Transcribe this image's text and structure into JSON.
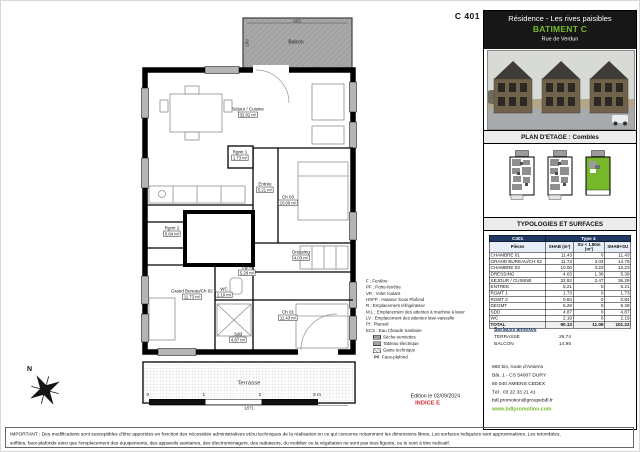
{
  "plan": {
    "unit_label": "C 401",
    "balcony_label": "Balcon",
    "terrace_label": "Terrasse",
    "dimensions": {
      "balcony_width": "603",
      "balcony_depth": "169",
      "terrace_width": "1871"
    },
    "rooms": [
      {
        "name": "Séjour / Cuisine",
        "area": "32.82 m²"
      },
      {
        "name": "Rgmt 1",
        "area": "1.73 m²"
      },
      {
        "name": "Entrée",
        "area": "5.21 m²"
      },
      {
        "name": "Ch 03",
        "area": "10.00 m²"
      },
      {
        "name": "Rgmt 2",
        "area": "0.84 m²"
      },
      {
        "name": "Dressing",
        "area": "4.03 m²"
      },
      {
        "name": "Dgmt",
        "area": "5.28 m²"
      },
      {
        "name": "Grand Bureau/Ch 02",
        "area": "11.73 m²"
      },
      {
        "name": "WC",
        "area": "2.19 m²"
      },
      {
        "name": "Sdd",
        "area": "4.87 m²"
      },
      {
        "name": "Ch 01",
        "area": "11.43 m²"
      }
    ],
    "legend": {
      "abbreviations": [
        "F : Fenêtre",
        "PF : Porte-fenêtre",
        "VR : Volet roulant",
        "HSFP : Hauteur Sous Plafond",
        "R : Emplacement réfrigérateur",
        "M.L : Emplacement des attentes à machine à laver",
        "LV : Emplacement des attentes lave-vaisselle",
        "Pl : Placard",
        "ECS : Eau Chaude Sanitaire"
      ],
      "symbols": [
        "Sèche-serviettes",
        "Tableau électrique",
        "Gaine technique",
        "Faux-plafond"
      ]
    },
    "compass": "N",
    "scale_ticks": [
      "0",
      "1",
      "2",
      "3 m"
    ],
    "edition": "Edition le 02/09/2024",
    "indice": "INDICE E"
  },
  "panel": {
    "header": {
      "title": "Résidence - Les rives paisibles",
      "building": "BATIMENT C",
      "street": "Rue de Verdun"
    },
    "floor_plan_title": "PLAN D'ETAGE : Combles",
    "typologies_title": "TYPOLOGIES ET SURFACES",
    "table": {
      "unit": "C401",
      "type": "Type 4",
      "columns": [
        "Pièces",
        "SHAB (m²)",
        "SU < 1.80m (m²)",
        "SHAB+SU"
      ],
      "rows": [
        [
          "CHAMBRE 01",
          "11.43",
          "0",
          "11.43"
        ],
        [
          "GRAND BUREAU/CH 02",
          "11.73",
          "3.03",
          "14.76"
        ],
        [
          "CHAMBRE 03",
          "10.00",
          "3.23",
          "13.23"
        ],
        [
          "DRESSING",
          "4.03",
          "1.36",
          "5.39"
        ],
        [
          "SEJOUR / CUISINE",
          "32.82",
          "3.47",
          "36.29"
        ],
        [
          "ENTREE",
          "5.21",
          "0",
          "5.21"
        ],
        [
          "RGMT 1",
          "1.73",
          "0",
          "1.73"
        ],
        [
          "RGMT 2",
          "0.84",
          "0",
          "0.84"
        ],
        [
          "DEGMT",
          "5.28",
          "0",
          "5.28"
        ],
        [
          "SDD",
          "4.87",
          "0",
          "4.87"
        ],
        [
          "WC",
          "2.19",
          "0",
          "2.19"
        ]
      ],
      "total": [
        "TOTAL",
        "90.13",
        "11.09",
        "101.22"
      ]
    },
    "annexes": {
      "title": "Surfaces annexes",
      "rows": [
        [
          "TERRASSE",
          "26.74"
        ],
        [
          "BALCON",
          "14.95"
        ]
      ]
    },
    "contact": {
      "logo_text": "BDL PROMOTION",
      "lines": [
        "660 bis, route d'Amiens",
        "Bât. 1 - CS 54007 DURY",
        "80 040 AMIENS CEDEX",
        "Tél : 03 22 33 21 41",
        "bdl.promotion@groupebdl.fr"
      ],
      "website": "www.bdlpromotion.com"
    }
  },
  "footer": {
    "line1": "IMPORTANT : Des modifications sont susceptibles d'être apportées en fonction des nécessités administratives et/ou techniques de la réalisation en ce qui concerne notamment les dimensions libres. Les surfaces indiquées sont approximatives. Les retombées,",
    "line2": "soffites, faux-plafonds ainsi que l'emplacement des équipements, des appareils sanitaires, des électroménagers, des radiateurs, du mobilier ou la végétation ne sont pas tous figurés, ou le sont à titre indicatif."
  },
  "colors": {
    "accent_green": "#76b82a",
    "table_navy": "#1f3864",
    "indice_red": "#d32b2b",
    "balcony_gray": "#a8a8a8"
  }
}
